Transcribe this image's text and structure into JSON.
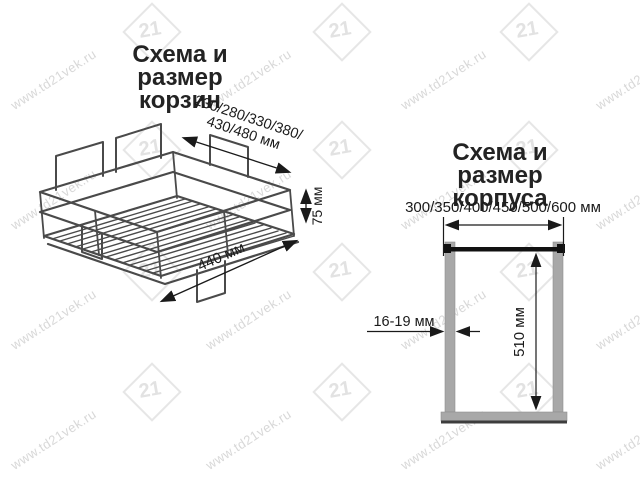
{
  "watermark": {
    "text": "www.td21vek.ru",
    "logo_text": "21",
    "text_color": "#d8d8d8",
    "logo_color": "#e4e4e4"
  },
  "left_panel": {
    "title_lines": [
      "Схема и размер",
      "корзин"
    ],
    "basket": {
      "width_label_lines": [
        "230/280/330/380/",
        "430/480 мм"
      ],
      "height_label": "75 мм",
      "depth_label": "440 мм",
      "wire_color": "#4a4a4a"
    }
  },
  "right_panel": {
    "title_lines": [
      "Схема и размер",
      "корпуса"
    ],
    "cabinet": {
      "width_label": "300/350/400/450/500/600 мм",
      "height_label": "510 мм",
      "thickness_label": "16-19 мм",
      "wall_color": "#a8a8a8",
      "rail_color": "#111111",
      "line_color": "#1a1a1a"
    }
  }
}
